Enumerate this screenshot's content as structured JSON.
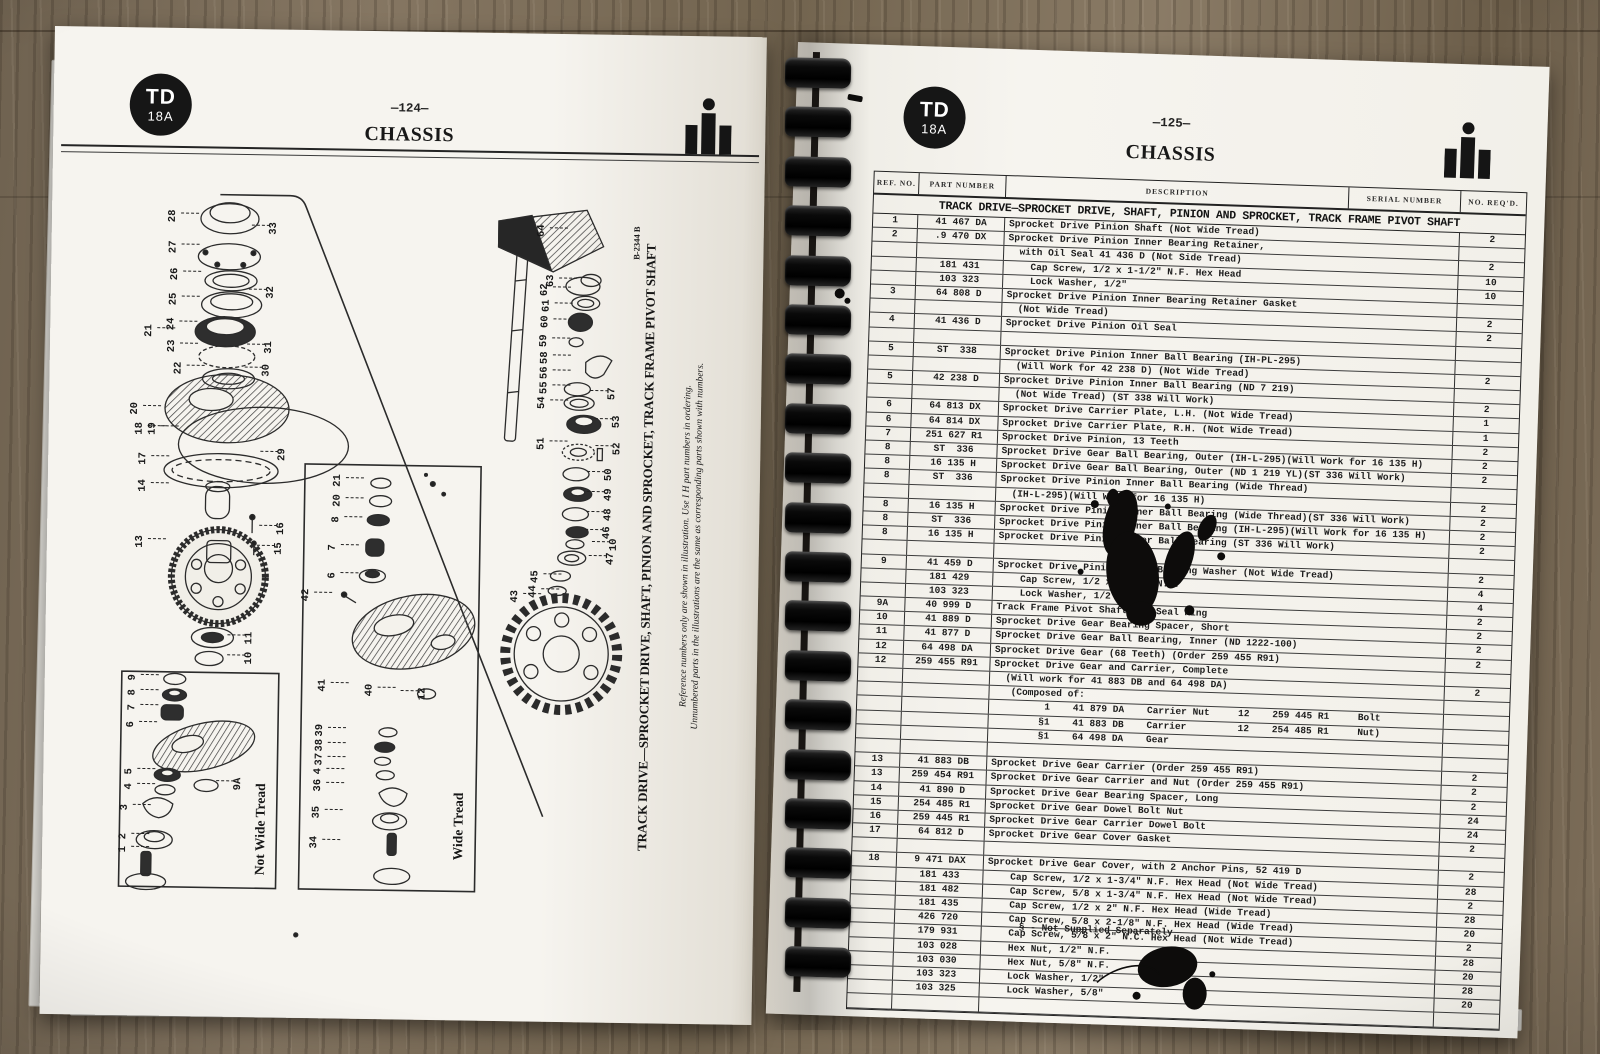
{
  "book": {
    "model_badge": {
      "line1": "TD",
      "line2": "18A"
    },
    "brand_icon": "ih-logo"
  },
  "left_page": {
    "page_number": "—124—",
    "title": "CHASSIS",
    "figure_number": "B-2344 B",
    "caption_title": "TRACK DRIVE—SPROCKET DRIVE, SHAFT, PINION AND SPROCKET, TRACK FRAME PIVOT SHAFT",
    "caption_note1": "Reference numbers only are shown in illustration.  Use I H part numbers in ordering.",
    "caption_note2": "Unnumbered parts in the illustrations are the same as corresponding parts shown with numbers.",
    "box_label_not_wide_tread": "Not Wide Tread",
    "box_label_wide_tread": "Wide Tread",
    "callouts": [
      {
        "n": "28",
        "x": 123,
        "y": 188,
        "d": 1
      },
      {
        "n": "27",
        "x": 124,
        "y": 219,
        "d": 1
      },
      {
        "n": "26",
        "x": 126,
        "y": 246,
        "d": 1
      },
      {
        "n": "25",
        "x": 125,
        "y": 271,
        "d": 1
      },
      {
        "n": "24",
        "x": 123,
        "y": 296,
        "d": 1
      },
      {
        "n": "23",
        "x": 124,
        "y": 318,
        "d": 1
      },
      {
        "n": "22",
        "x": 131,
        "y": 340,
        "d": 1
      },
      {
        "n": "21",
        "x": 101,
        "y": 303,
        "d": 1
      },
      {
        "n": "20",
        "x": 88,
        "y": 381,
        "d": 1
      },
      {
        "n": "18",
        "x": 93,
        "y": 401,
        "d": 1
      },
      {
        "n": "19",
        "x": 106,
        "y": 401,
        "d": 1
      },
      {
        "n": "17",
        "x": 97,
        "y": 431,
        "d": 1
      },
      {
        "n": "14",
        "x": 97,
        "y": 458,
        "d": 1
      },
      {
        "n": "13",
        "x": 95,
        "y": 514,
        "d": 1
      },
      {
        "n": "33",
        "x": 224,
        "y": 199,
        "d": -1
      },
      {
        "n": "32",
        "x": 222,
        "y": 263,
        "d": -1
      },
      {
        "n": "31",
        "x": 221,
        "y": 318,
        "d": -1
      },
      {
        "n": "30",
        "x": 219,
        "y": 341,
        "d": -1
      },
      {
        "n": "29",
        "x": 236,
        "y": 425,
        "d": -1
      },
      {
        "n": "16",
        "x": 236,
        "y": 499,
        "d": -1
      },
      {
        "n": "15",
        "x": 234,
        "y": 519,
        "d": -1
      },
      {
        "n": "11",
        "x": 206,
        "y": 609,
        "d": -1
      },
      {
        "n": "10",
        "x": 206,
        "y": 629,
        "d": -1
      },
      {
        "n": "64",
        "x": 492,
        "y": 197,
        "d": 1
      },
      {
        "n": "63",
        "x": 502,
        "y": 247,
        "d": 1
      },
      {
        "n": "62",
        "x": 496,
        "y": 256,
        "d": 1
      },
      {
        "n": "61",
        "x": 498,
        "y": 272,
        "d": 1
      },
      {
        "n": "60",
        "x": 497,
        "y": 288,
        "d": 1
      },
      {
        "n": "59",
        "x": 496,
        "y": 307,
        "d": 1
      },
      {
        "n": "58",
        "x": 497,
        "y": 324,
        "d": 1
      },
      {
        "n": "56",
        "x": 497,
        "y": 339,
        "d": 1
      },
      {
        "n": "55",
        "x": 497,
        "y": 354,
        "d": 1
      },
      {
        "n": "54",
        "x": 495,
        "y": 369,
        "d": 1
      },
      {
        "n": "57",
        "x": 565,
        "y": 359,
        "d": -1
      },
      {
        "n": "53",
        "x": 570,
        "y": 387,
        "d": -1
      },
      {
        "n": "51",
        "x": 495,
        "y": 410,
        "d": 1
      },
      {
        "n": "52",
        "x": 571,
        "y": 414,
        "d": -1
      },
      {
        "n": "50",
        "x": 563,
        "y": 440,
        "d": -1
      },
      {
        "n": "49",
        "x": 563,
        "y": 460,
        "d": -1
      },
      {
        "n": "48",
        "x": 563,
        "y": 480,
        "d": -1
      },
      {
        "n": "46",
        "x": 562,
        "y": 498,
        "d": -1
      },
      {
        "n": "10",
        "x": 569,
        "y": 510,
        "d": -1
      },
      {
        "n": "47",
        "x": 566,
        "y": 524,
        "d": -1
      },
      {
        "n": "45",
        "x": 491,
        "y": 543,
        "d": 1
      },
      {
        "n": "44",
        "x": 489,
        "y": 558,
        "d": 1
      },
      {
        "n": "43",
        "x": 471,
        "y": 563,
        "d": 1
      },
      {
        "n": "9",
        "x": 90,
        "y": 650,
        "d": 1
      },
      {
        "n": "8",
        "x": 90,
        "y": 665,
        "d": 1
      },
      {
        "n": "7",
        "x": 90,
        "y": 680,
        "d": 1
      },
      {
        "n": "6",
        "x": 89,
        "y": 697,
        "d": 1
      },
      {
        "n": "5",
        "x": 88,
        "y": 744,
        "d": 1
      },
      {
        "n": "4",
        "x": 88,
        "y": 759,
        "d": 1
      },
      {
        "n": "3",
        "x": 84,
        "y": 780,
        "d": 1
      },
      {
        "n": "2",
        "x": 83,
        "y": 809,
        "d": 1
      },
      {
        "n": "1",
        "x": 83,
        "y": 822,
        "d": 1
      },
      {
        "n": "9A",
        "x": 197,
        "y": 755,
        "d": -1
      },
      {
        "n": "21",
        "x": 292,
        "y": 450,
        "d": 1
      },
      {
        "n": "20",
        "x": 292,
        "y": 470,
        "d": 1
      },
      {
        "n": "8",
        "x": 291,
        "y": 489,
        "d": 1
      },
      {
        "n": "7",
        "x": 288,
        "y": 517,
        "d": 1
      },
      {
        "n": "6",
        "x": 288,
        "y": 545,
        "d": 1
      },
      {
        "n": "42",
        "x": 262,
        "y": 565,
        "d": 1
      },
      {
        "n": "41",
        "x": 280,
        "y": 655,
        "d": 1
      },
      {
        "n": "40",
        "x": 327,
        "y": 659,
        "d": 1
      },
      {
        "n": "12",
        "x": 380,
        "y": 662,
        "d": -1
      },
      {
        "n": "39",
        "x": 278,
        "y": 700,
        "d": 1
      },
      {
        "n": "38",
        "x": 278,
        "y": 715,
        "d": 1
      },
      {
        "n": "37",
        "x": 278,
        "y": 729,
        "d": 1
      },
      {
        "n": "4",
        "x": 277,
        "y": 741,
        "d": 1
      },
      {
        "n": "36",
        "x": 277,
        "y": 755,
        "d": 1
      },
      {
        "n": "35",
        "x": 276,
        "y": 782,
        "d": 1
      },
      {
        "n": "34",
        "x": 274,
        "y": 812,
        "d": 1
      }
    ]
  },
  "right_page": {
    "page_number": "—125—",
    "title": "CHASSIS",
    "table": {
      "headers": [
        "REF. NO.",
        "PART NUMBER",
        "DESCRIPTION",
        "SERIAL NUMBER",
        "NO. REQ'D."
      ],
      "section_title": "TRACK DRIVE—SPROCKET DRIVE, SHAFT, PINION AND SPROCKET, TRACK FRAME PIVOT SHAFT",
      "rows": [
        {
          "ref": "1",
          "part": "41 467 DA",
          "desc": "Sprocket Drive Pinion Shaft (Not Wide Tread)",
          "req": "2"
        },
        {
          "ref": "2",
          "part": ".9 470 DX",
          "desc": "Sprocket Drive Pinion Inner Bearing Retainer,",
          "req": ""
        },
        {
          "ref": "",
          "part": "",
          "desc": "  with Oil Seal 41 436 D (Not Side Tread)",
          "req": "2"
        },
        {
          "ref": "",
          "part": "181 431",
          "desc": "    Cap Screw, 1/2 x 1-1/2\" N.F. Hex Head",
          "req": "10"
        },
        {
          "ref": "",
          "part": "103 323",
          "desc": "    Lock Washer, 1/2\"",
          "req": "10"
        },
        {
          "ref": "3",
          "part": "64 808 D",
          "desc": "Sprocket Drive Pinion Inner Bearing Retainer Gasket",
          "req": ""
        },
        {
          "ref": "",
          "part": "",
          "desc": "  (Not Wide Tread)",
          "req": "2"
        },
        {
          "ref": "4",
          "part": "41 436 D",
          "desc": "Sprocket Drive Pinion Oil Seal",
          "req": "2"
        },
        {
          "spacer": true
        },
        {
          "ref": "5",
          "part": "ST  338",
          "desc": "Sprocket Drive Pinion Inner Ball Bearing (IH-PL-295)",
          "req": ""
        },
        {
          "ref": "",
          "part": "",
          "desc": "  (Will Work for 42 238 D) (Not Wide Tread)",
          "req": "2"
        },
        {
          "ref": "5",
          "part": "42 238 D",
          "desc": "Sprocket Drive Pinion Inner Ball Bearing (ND 7 219)",
          "req": ""
        },
        {
          "ref": "",
          "part": "",
          "desc": "  (Not Wide Tread) (ST 338 Will Work)",
          "req": "2"
        },
        {
          "ref": "6",
          "part": "64 813 DX",
          "desc": "Sprocket Drive Carrier Plate, L.H. (Not Wide Tread)",
          "req": "1"
        },
        {
          "ref": "6",
          "part": "64 814 DX",
          "desc": "Sprocket Drive Carrier Plate, R.H. (Not Wide Tread)",
          "req": "1"
        },
        {
          "ref": "7",
          "part": "251 627 R1",
          "desc": "Sprocket Drive Pinion, 13 Teeth",
          "req": "2"
        },
        {
          "ref": "8",
          "part": "ST  336",
          "desc": "Sprocket Drive Gear Ball Bearing, Outer (IH-L-295)(Will Work for 16 135 H)",
          "req": "2"
        },
        {
          "ref": "8",
          "part": "16 135 H",
          "desc": "Sprocket Drive Gear Ball Bearing, Outer (ND 1 219 YL)(ST 336 Will Work)",
          "req": "2"
        },
        {
          "ref": "8",
          "part": "ST  336",
          "desc": "Sprocket Drive Pinion Inner Ball Bearing (Wide Thread)",
          "req": ""
        },
        {
          "ref": "",
          "part": "",
          "desc": "  (IH-L-295)(Will Work for 16 135 H)",
          "req": "2"
        },
        {
          "ref": "8",
          "part": "16 135 H",
          "desc": "Sprocket Drive Pinion Inner Ball Bearing (Wide Thread)(ST 336 Will Work)",
          "req": "2"
        },
        {
          "ref": "8",
          "part": "ST  336",
          "desc": "Sprocket Drive Pinion Inner Ball Bearing (IH-L-295)(Will Work for 16 135 H)",
          "req": "2"
        },
        {
          "ref": "8",
          "part": "16 135 H",
          "desc": "Sprocket Drive Pinion Inner Ball Bearing (ST 336 Will Work)",
          "req": "2"
        },
        {
          "spacer": true
        },
        {
          "ref": "9",
          "part": "41 459 D",
          "desc": "Sprocket Drive Pinion Outer Bearing Washer (Not Wide Tread)",
          "req": "2"
        },
        {
          "ref": "",
          "part": "181 429",
          "desc": "    Cap Screw, 1/2 x 1-1/4\" N.F.",
          "req": "4"
        },
        {
          "ref": "",
          "part": "103 323",
          "desc": "    Lock Washer, 1/2\"",
          "req": "4"
        },
        {
          "ref": "9A",
          "part": "40 999 D",
          "desc": "Track Frame Pivot Shaft Oil Seal Ring",
          "req": "2"
        },
        {
          "ref": "10",
          "part": "41 889 D",
          "desc": "Sprocket Drive Gear Bearing Spacer, Short",
          "req": "2"
        },
        {
          "ref": "11",
          "part": "41 877 D",
          "desc": "Sprocket Drive Gear Ball Bearing, Inner (ND 1222-100)",
          "req": "2"
        },
        {
          "ref": "12",
          "part": "64 498 DA",
          "desc": "Sprocket Drive Gear (68 Teeth) (Order 259 455 R91)",
          "req": "2"
        },
        {
          "ref": "12",
          "part": "259 455 R91",
          "desc": "Sprocket Drive Gear and Carrier, Complete",
          "req": ""
        },
        {
          "ref": "",
          "part": "",
          "desc": "  (Will work for 41 883 DB and 64 498 DA)",
          "req": "2"
        },
        {
          "ref": "",
          "part": "",
          "desc": "   (Composed of:",
          "req": ""
        },
        {
          "ref": "",
          "part": "",
          "desc": "         1    41 879 DA    Carrier Nut     12    259 445 R1     Bolt",
          "req": ""
        },
        {
          "ref": "",
          "part": "",
          "desc": "        §1    41 883 DB    Carrier         12    254 485 R1     Nut)",
          "req": ""
        },
        {
          "ref": "",
          "part": "",
          "desc": "        §1    64 498 DA    Gear",
          "req": ""
        },
        {
          "spacer": true
        },
        {
          "ref": "13",
          "part": "41 883 DB",
          "desc": "Sprocket Drive Gear Carrier (Order 259 455 R91)",
          "req": "2"
        },
        {
          "ref": "13",
          "part": "259 454 R91",
          "desc": "Sprocket Drive Gear Carrier and Nut (Order 259 455 R91)",
          "req": "2"
        },
        {
          "ref": "14",
          "part": "41 890 D",
          "desc": "Sprocket Drive Gear Bearing Spacer, Long",
          "req": "2"
        },
        {
          "ref": "15",
          "part": "254 485 R1",
          "desc": "Sprocket Drive Gear Dowel Bolt Nut",
          "req": "24"
        },
        {
          "ref": "16",
          "part": "259 445 R1",
          "desc": "Sprocket Drive Gear Carrier Dowel Bolt",
          "req": "24"
        },
        {
          "ref": "17",
          "part": "64 812 D",
          "desc": "Sprocket Drive Gear Cover Gasket",
          "req": "2"
        },
        {
          "spacer": true
        },
        {
          "ref": "18",
          "part": "9 471 DAX",
          "desc": "Sprocket Drive Gear Cover, with 2 Anchor Pins, 52 419 D",
          "req": "2"
        },
        {
          "ref": "",
          "part": "181 433",
          "desc": "    Cap Screw, 1/2 x 1-3/4\" N.F. Hex Head (Not Wide Tread)",
          "req": "28"
        },
        {
          "ref": "",
          "part": "181 482",
          "desc": "    Cap Screw, 5/8 x 1-3/4\" N.F. Hex Head (Not Wide Tread)",
          "req": "2"
        },
        {
          "ref": "",
          "part": "181 435",
          "desc": "    Cap Screw, 1/2 x 2\" N.F. Hex Head (Wide Tread)",
          "req": "28"
        },
        {
          "ref": "",
          "part": "426 720",
          "desc": "    Cap Screw, 5/8 x 2-1/8\" N.F. Hex Head (Wide Tread)",
          "req": "20"
        },
        {
          "ref": "",
          "part": "179 931",
          "desc": "    Cap Screw, 5/8 x 2\" N.C. Hex Head (Not Wide Tread)",
          "req": "2"
        },
        {
          "ref": "",
          "part": "103 028",
          "desc": "    Hex Nut, 1/2\" N.F.",
          "req": "28"
        },
        {
          "ref": "",
          "part": "103 030",
          "desc": "    Hex Nut, 5/8\" N.F.",
          "req": "20"
        },
        {
          "ref": "",
          "part": "103 323",
          "desc": "    Lock Washer, 1/2\"",
          "req": "28"
        },
        {
          "ref": "",
          "part": "103 325",
          "desc": "    Lock Washer, 5/8\"",
          "req": "20"
        },
        {
          "spacer": true
        }
      ],
      "footnote": "§ - Not Supplied Separately"
    }
  }
}
